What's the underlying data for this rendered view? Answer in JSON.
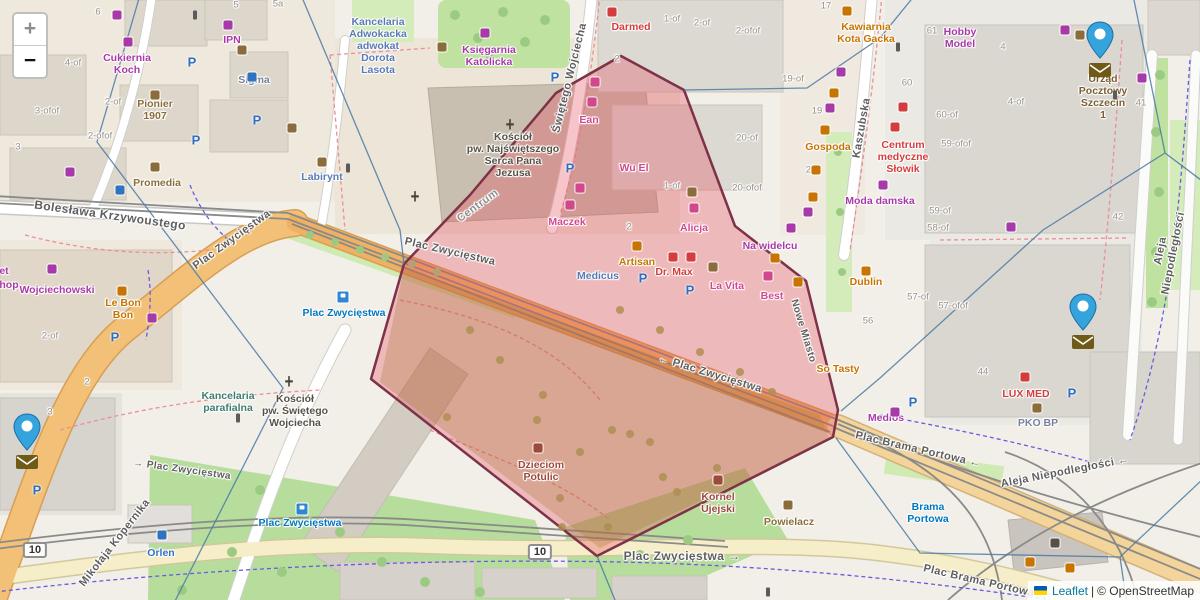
{
  "controls": {
    "zoom_in": "+",
    "zoom_out": "−"
  },
  "attribution": {
    "leaflet": "Leaflet",
    "separator": "|",
    "osm": "© OpenStreetMap",
    "flag_top": "#005bbb",
    "flag_bottom": "#ffd500"
  },
  "palette": {
    "purple": "#a839a8",
    "pink": "#d1488f",
    "orange": "#c77400",
    "red": "#d43d3d",
    "rust": "#9c4a3c",
    "brown": "#8a6d3b",
    "post": "#7a6030",
    "blue": "#2f74c0",
    "transit": "#0078c1",
    "office": "#5a7ab5",
    "steel": "#76839b",
    "green": "#3f7d6e",
    "dark": "#575247",
    "marker_blue": "#35a3dc",
    "envelope_brown": "#6f5b17",
    "polygon_fill": "rgba(231,76,90,0.33)",
    "polygon_stroke": "#7d3247"
  },
  "service_area": {
    "points": "621,56 684,90 735,226 806,281 838,410 833,437 597,556 371,379 404,264 470,195 556,93"
  },
  "boundary_lines": [
    "140,-5 97,142 283,388 173,605",
    "301,-5 400,230 404,264",
    "597,556 617,605",
    "915,-5 880,38 807,88 684,90",
    "1133,-5 1165,153",
    "1165,153 1205,183",
    "1165,153 1043,230 880,378 841,411",
    "836,438 920,553 1120,557",
    "1120,557 1205,477",
    "1120,557 1127,605"
  ],
  "markers": [
    {
      "name": "post-office-marker-1",
      "x": 1100,
      "y": 58
    },
    {
      "name": "post-office-marker-2",
      "x": 1083,
      "y": 330
    },
    {
      "name": "post-office-marker-3",
      "x": 27,
      "y": 450
    }
  ],
  "streets": [
    {
      "t": "Bolesława Krzywoustego",
      "x": 110,
      "y": 216,
      "r": 8,
      "s": 12
    },
    {
      "t": "Plac Zwycięstwa",
      "x": 232,
      "y": 240,
      "r": -36,
      "s": 11
    },
    {
      "t": "Plac Zwycięstwa",
      "x": 450,
      "y": 252,
      "r": 13,
      "s": 11
    },
    {
      "t": "← Plac Zwycięstwa",
      "x": 710,
      "y": 374,
      "r": 17,
      "s": 11
    },
    {
      "t": "→ Plac Zwycięstwa",
      "x": 182,
      "y": 470,
      "r": 8,
      "s": 10
    },
    {
      "t": "Plac Zwycięstwa →",
      "x": 682,
      "y": 557,
      "r": 0,
      "s": 12
    },
    {
      "t": "Mikołaja Kopernika",
      "x": 115,
      "y": 543,
      "r": -52,
      "s": 11
    },
    {
      "t": "Świętego Wojciecha",
      "x": 570,
      "y": 78,
      "r": -76,
      "s": 11
    },
    {
      "t": "Kaszubska",
      "x": 862,
      "y": 128,
      "r": -80,
      "s": 11
    },
    {
      "t": "Aleja Niepodległości",
      "x": 1167,
      "y": 252,
      "r": -79,
      "s": 11
    },
    {
      "t": "Aleja Niepodległości ←",
      "x": 1065,
      "y": 472,
      "r": -11,
      "s": 11
    },
    {
      "t": "Plac Brama Portowa ←",
      "x": 918,
      "y": 450,
      "r": 13,
      "s": 11
    },
    {
      "t": "Plac Brama Portowa →",
      "x": 986,
      "y": 583,
      "r": 13,
      "s": 11
    },
    {
      "t": "Nowe Miasto",
      "x": 803,
      "y": 331,
      "r": 73,
      "s": 10
    },
    {
      "t": "Centrum",
      "x": 478,
      "y": 206,
      "r": -36,
      "s": 11,
      "c": "#8f8f8f"
    }
  ],
  "transit_stops": [
    {
      "t": "Plac Zwycięstwa",
      "x": 344,
      "y": 313
    },
    {
      "t": "Plac Zwycięstwa",
      "x": 300,
      "y": 523
    },
    {
      "t": "Brama\nPortowa",
      "x": 928,
      "y": 513
    }
  ],
  "pois": [
    {
      "t": "Cukiernia\nKoch",
      "x": 127,
      "y": 64,
      "c": "purple"
    },
    {
      "t": "IPN",
      "x": 232,
      "y": 40,
      "c": "purple"
    },
    {
      "t": "Sigma",
      "x": 254,
      "y": 80,
      "c": "steel"
    },
    {
      "t": "Pionier\n1907",
      "x": 155,
      "y": 110,
      "c": "brown"
    },
    {
      "t": "Promedia",
      "x": 157,
      "y": 183,
      "c": "brown"
    },
    {
      "t": "Wojciechowski",
      "x": 57,
      "y": 290,
      "c": "purple"
    },
    {
      "t": "et",
      "x": 4,
      "y": 271,
      "c": "purple"
    },
    {
      "t": "hop",
      "x": 9,
      "y": 285,
      "c": "purple"
    },
    {
      "t": "Le Bon\nBon",
      "x": 123,
      "y": 309,
      "c": "orange"
    },
    {
      "t": "Labirynt",
      "x": 322,
      "y": 177,
      "c": "office"
    },
    {
      "t": "Kancelaria\nAdwokacka\nadwokat\nDorota\nLasota",
      "x": 378,
      "y": 46,
      "c": "office"
    },
    {
      "t": "Księgarnia\nKatolicka",
      "x": 489,
      "y": 56,
      "c": "purple"
    },
    {
      "t": "Kościół\npw. Najświętszego\nSerca Pana\nJezusa",
      "x": 513,
      "y": 155,
      "c": "dark"
    },
    {
      "t": "Darmed",
      "x": 631,
      "y": 27,
      "c": "red"
    },
    {
      "t": "Kawiarnia\nKota Gacka",
      "x": 866,
      "y": 33,
      "c": "orange"
    },
    {
      "t": "Hobby\nModel",
      "x": 960,
      "y": 38,
      "c": "purple"
    },
    {
      "t": "Urząd\nPocztowy\nSzczecin\n1",
      "x": 1103,
      "y": 97,
      "c": "post"
    },
    {
      "t": "Centrum\nmedyczne\nSłowik",
      "x": 903,
      "y": 157,
      "c": "red"
    },
    {
      "t": "Gospoda",
      "x": 828,
      "y": 147,
      "c": "orange"
    },
    {
      "t": "Moda damska",
      "x": 880,
      "y": 201,
      "c": "purple"
    },
    {
      "t": "Ean",
      "x": 589,
      "y": 120,
      "c": "pink"
    },
    {
      "t": "Wu El",
      "x": 634,
      "y": 168,
      "c": "pink"
    },
    {
      "t": "Maczek",
      "x": 567,
      "y": 222,
      "c": "pink"
    },
    {
      "t": "Alicja",
      "x": 694,
      "y": 228,
      "c": "pink"
    },
    {
      "t": "Artisan",
      "x": 637,
      "y": 262,
      "c": "orange"
    },
    {
      "t": "Dr. Max",
      "x": 674,
      "y": 272,
      "c": "red"
    },
    {
      "t": "Medicus",
      "x": 598,
      "y": 276,
      "c": "office"
    },
    {
      "t": "La Vita",
      "x": 727,
      "y": 286,
      "c": "pink"
    },
    {
      "t": "Best",
      "x": 772,
      "y": 296,
      "c": "pink"
    },
    {
      "t": "Na widelcu",
      "x": 770,
      "y": 246,
      "c": "purple"
    },
    {
      "t": "Dublin",
      "x": 866,
      "y": 282,
      "c": "orange"
    },
    {
      "t": "So Tasty",
      "x": 838,
      "y": 369,
      "c": "orange"
    },
    {
      "t": "Medios",
      "x": 886,
      "y": 418,
      "c": "purple"
    },
    {
      "t": "LUX MED",
      "x": 1026,
      "y": 394,
      "c": "red"
    },
    {
      "t": "PKO BP",
      "x": 1038,
      "y": 423,
      "c": "steel"
    },
    {
      "t": "Kancelaria\nparafialna",
      "x": 228,
      "y": 402,
      "c": "green"
    },
    {
      "t": "Kościół\npw. Świętego\nWojciecha",
      "x": 295,
      "y": 411,
      "c": "dark"
    },
    {
      "t": "Orlen",
      "x": 161,
      "y": 553,
      "c": "blue"
    },
    {
      "t": "Dzieciom\nPotulic",
      "x": 541,
      "y": 471,
      "c": "rust"
    },
    {
      "t": "Kornel\nUjejski",
      "x": 718,
      "y": 503,
      "c": "rust"
    },
    {
      "t": "Powielacz",
      "x": 789,
      "y": 522,
      "c": "brown"
    }
  ],
  "house_numbers": [
    {
      "t": "6",
      "x": 98,
      "y": 13
    },
    {
      "t": "4-of",
      "x": 73,
      "y": 64
    },
    {
      "t": "3-ofof",
      "x": 47,
      "y": 112
    },
    {
      "t": "2-of",
      "x": 113,
      "y": 103
    },
    {
      "t": "2-ofof",
      "x": 100,
      "y": 137
    },
    {
      "t": "3",
      "x": 18,
      "y": 148
    },
    {
      "t": "5",
      "x": 236,
      "y": 6
    },
    {
      "t": "5a",
      "x": 278,
      "y": 5
    },
    {
      "t": "1-of",
      "x": 672,
      "y": 20
    },
    {
      "t": "2-of",
      "x": 702,
      "y": 24
    },
    {
      "t": "2-ofof",
      "x": 748,
      "y": 32
    },
    {
      "t": "17",
      "x": 826,
      "y": 7
    },
    {
      "t": "19-of",
      "x": 793,
      "y": 80
    },
    {
      "t": "19",
      "x": 817,
      "y": 112
    },
    {
      "t": "20-of",
      "x": 747,
      "y": 139
    },
    {
      "t": "20",
      "x": 811,
      "y": 171
    },
    {
      "t": "20-ofof",
      "x": 747,
      "y": 189
    },
    {
      "t": "2",
      "x": 617,
      "y": 60
    },
    {
      "t": "1-of",
      "x": 672,
      "y": 187
    },
    {
      "t": "2",
      "x": 629,
      "y": 228
    },
    {
      "t": "61",
      "x": 932,
      "y": 32
    },
    {
      "t": "60",
      "x": 907,
      "y": 84
    },
    {
      "t": "60-of",
      "x": 947,
      "y": 116
    },
    {
      "t": "59-ofof",
      "x": 956,
      "y": 145
    },
    {
      "t": "59-of",
      "x": 940,
      "y": 212
    },
    {
      "t": "58-of",
      "x": 938,
      "y": 229
    },
    {
      "t": "4",
      "x": 1003,
      "y": 48
    },
    {
      "t": "4-of",
      "x": 1016,
      "y": 103
    },
    {
      "t": "41",
      "x": 1141,
      "y": 104
    },
    {
      "t": "42",
      "x": 1118,
      "y": 218
    },
    {
      "t": "57-of",
      "x": 918,
      "y": 298
    },
    {
      "t": "57-ofof",
      "x": 953,
      "y": 307
    },
    {
      "t": "56",
      "x": 868,
      "y": 322
    },
    {
      "t": "44",
      "x": 983,
      "y": 373
    },
    {
      "t": "3",
      "x": 50,
      "y": 413
    },
    {
      "t": "2-of",
      "x": 50,
      "y": 337
    },
    {
      "t": "2",
      "x": 87,
      "y": 383
    }
  ],
  "route_badges": [
    {
      "t": "10",
      "x": 35,
      "y": 550
    },
    {
      "t": "10",
      "x": 540,
      "y": 552
    }
  ],
  "poi_icons": [
    {
      "x": 117,
      "y": 15,
      "c": "purple"
    },
    {
      "x": 128,
      "y": 42,
      "c": "purple"
    },
    {
      "x": 228,
      "y": 25,
      "c": "purple"
    },
    {
      "x": 70,
      "y": 172,
      "c": "purple"
    },
    {
      "x": 52,
      "y": 269,
      "c": "purple"
    },
    {
      "x": 152,
      "y": 318,
      "c": "purple"
    },
    {
      "x": 883,
      "y": 185,
      "c": "purple"
    },
    {
      "x": 841,
      "y": 72,
      "c": "purple"
    },
    {
      "x": 830,
      "y": 108,
      "c": "purple"
    },
    {
      "x": 808,
      "y": 212,
      "c": "purple"
    },
    {
      "x": 1011,
      "y": 227,
      "c": "purple"
    },
    {
      "x": 1065,
      "y": 30,
      "c": "purple"
    },
    {
      "x": 1142,
      "y": 78,
      "c": "purple"
    },
    {
      "x": 895,
      "y": 412,
      "c": "purple"
    },
    {
      "x": 485,
      "y": 33,
      "c": "purple"
    },
    {
      "x": 791,
      "y": 228,
      "c": "purple"
    },
    {
      "x": 595,
      "y": 82,
      "c": "pink"
    },
    {
      "x": 592,
      "y": 102,
      "c": "pink"
    },
    {
      "x": 580,
      "y": 188,
      "c": "pink"
    },
    {
      "x": 570,
      "y": 205,
      "c": "pink"
    },
    {
      "x": 694,
      "y": 208,
      "c": "pink"
    },
    {
      "x": 768,
      "y": 276,
      "c": "pink"
    },
    {
      "x": 847,
      "y": 11,
      "c": "orange"
    },
    {
      "x": 834,
      "y": 93,
      "c": "orange"
    },
    {
      "x": 825,
      "y": 130,
      "c": "orange"
    },
    {
      "x": 816,
      "y": 170,
      "c": "orange"
    },
    {
      "x": 813,
      "y": 197,
      "c": "orange"
    },
    {
      "x": 637,
      "y": 246,
      "c": "orange"
    },
    {
      "x": 775,
      "y": 258,
      "c": "orange"
    },
    {
      "x": 798,
      "y": 282,
      "c": "orange"
    },
    {
      "x": 866,
      "y": 271,
      "c": "orange"
    },
    {
      "x": 1030,
      "y": 562,
      "c": "orange"
    },
    {
      "x": 1070,
      "y": 568,
      "c": "orange"
    },
    {
      "x": 122,
      "y": 291,
      "c": "orange"
    },
    {
      "x": 612,
      "y": 12,
      "c": "red"
    },
    {
      "x": 903,
      "y": 107,
      "c": "red"
    },
    {
      "x": 895,
      "y": 127,
      "c": "red"
    },
    {
      "x": 673,
      "y": 257,
      "c": "red"
    },
    {
      "x": 691,
      "y": 257,
      "c": "red"
    },
    {
      "x": 1025,
      "y": 377,
      "c": "red"
    },
    {
      "x": 538,
      "y": 448,
      "c": "rust"
    },
    {
      "x": 718,
      "y": 480,
      "c": "rust"
    },
    {
      "x": 155,
      "y": 95,
      "c": "brown"
    },
    {
      "x": 155,
      "y": 167,
      "c": "brown"
    },
    {
      "x": 442,
      "y": 47,
      "c": "brown"
    },
    {
      "x": 692,
      "y": 192,
      "c": "brown"
    },
    {
      "x": 713,
      "y": 267,
      "c": "brown"
    },
    {
      "x": 788,
      "y": 505,
      "c": "brown"
    },
    {
      "x": 292,
      "y": 128,
      "c": "brown"
    },
    {
      "x": 242,
      "y": 50,
      "c": "brown"
    },
    {
      "x": 1080,
      "y": 35,
      "c": "brown"
    },
    {
      "x": 1037,
      "y": 408,
      "c": "brown"
    },
    {
      "x": 322,
      "y": 162,
      "c": "brown"
    },
    {
      "x": 1055,
      "y": 543,
      "c": "dark"
    },
    {
      "x": 162,
      "y": 535,
      "c": "blue"
    },
    {
      "x": 120,
      "y": 190,
      "c": "blue"
    },
    {
      "x": 252,
      "y": 77,
      "c": "blue"
    }
  ],
  "parking_icons": [
    {
      "x": 192,
      "y": 62
    },
    {
      "x": 257,
      "y": 120
    },
    {
      "x": 196,
      "y": 140
    },
    {
      "x": 555,
      "y": 77
    },
    {
      "x": 570,
      "y": 168
    },
    {
      "x": 643,
      "y": 278
    },
    {
      "x": 690,
      "y": 290
    },
    {
      "x": 913,
      "y": 402
    },
    {
      "x": 1072,
      "y": 393
    },
    {
      "x": 37,
      "y": 490
    },
    {
      "x": 115,
      "y": 337
    }
  ],
  "tram_stop_icons": [
    {
      "x": 343,
      "y": 297
    },
    {
      "x": 302,
      "y": 509
    }
  ],
  "cross_icons": [
    {
      "x": 510,
      "y": 125
    },
    {
      "x": 289,
      "y": 382
    },
    {
      "x": 415,
      "y": 197
    }
  ],
  "traffic_signal_icons": [
    {
      "x": 195,
      "y": 15
    },
    {
      "x": 348,
      "y": 168
    },
    {
      "x": 238,
      "y": 418
    },
    {
      "x": 898,
      "y": 47
    },
    {
      "x": 1115,
      "y": 95
    },
    {
      "x": 768,
      "y": 592
    }
  ]
}
